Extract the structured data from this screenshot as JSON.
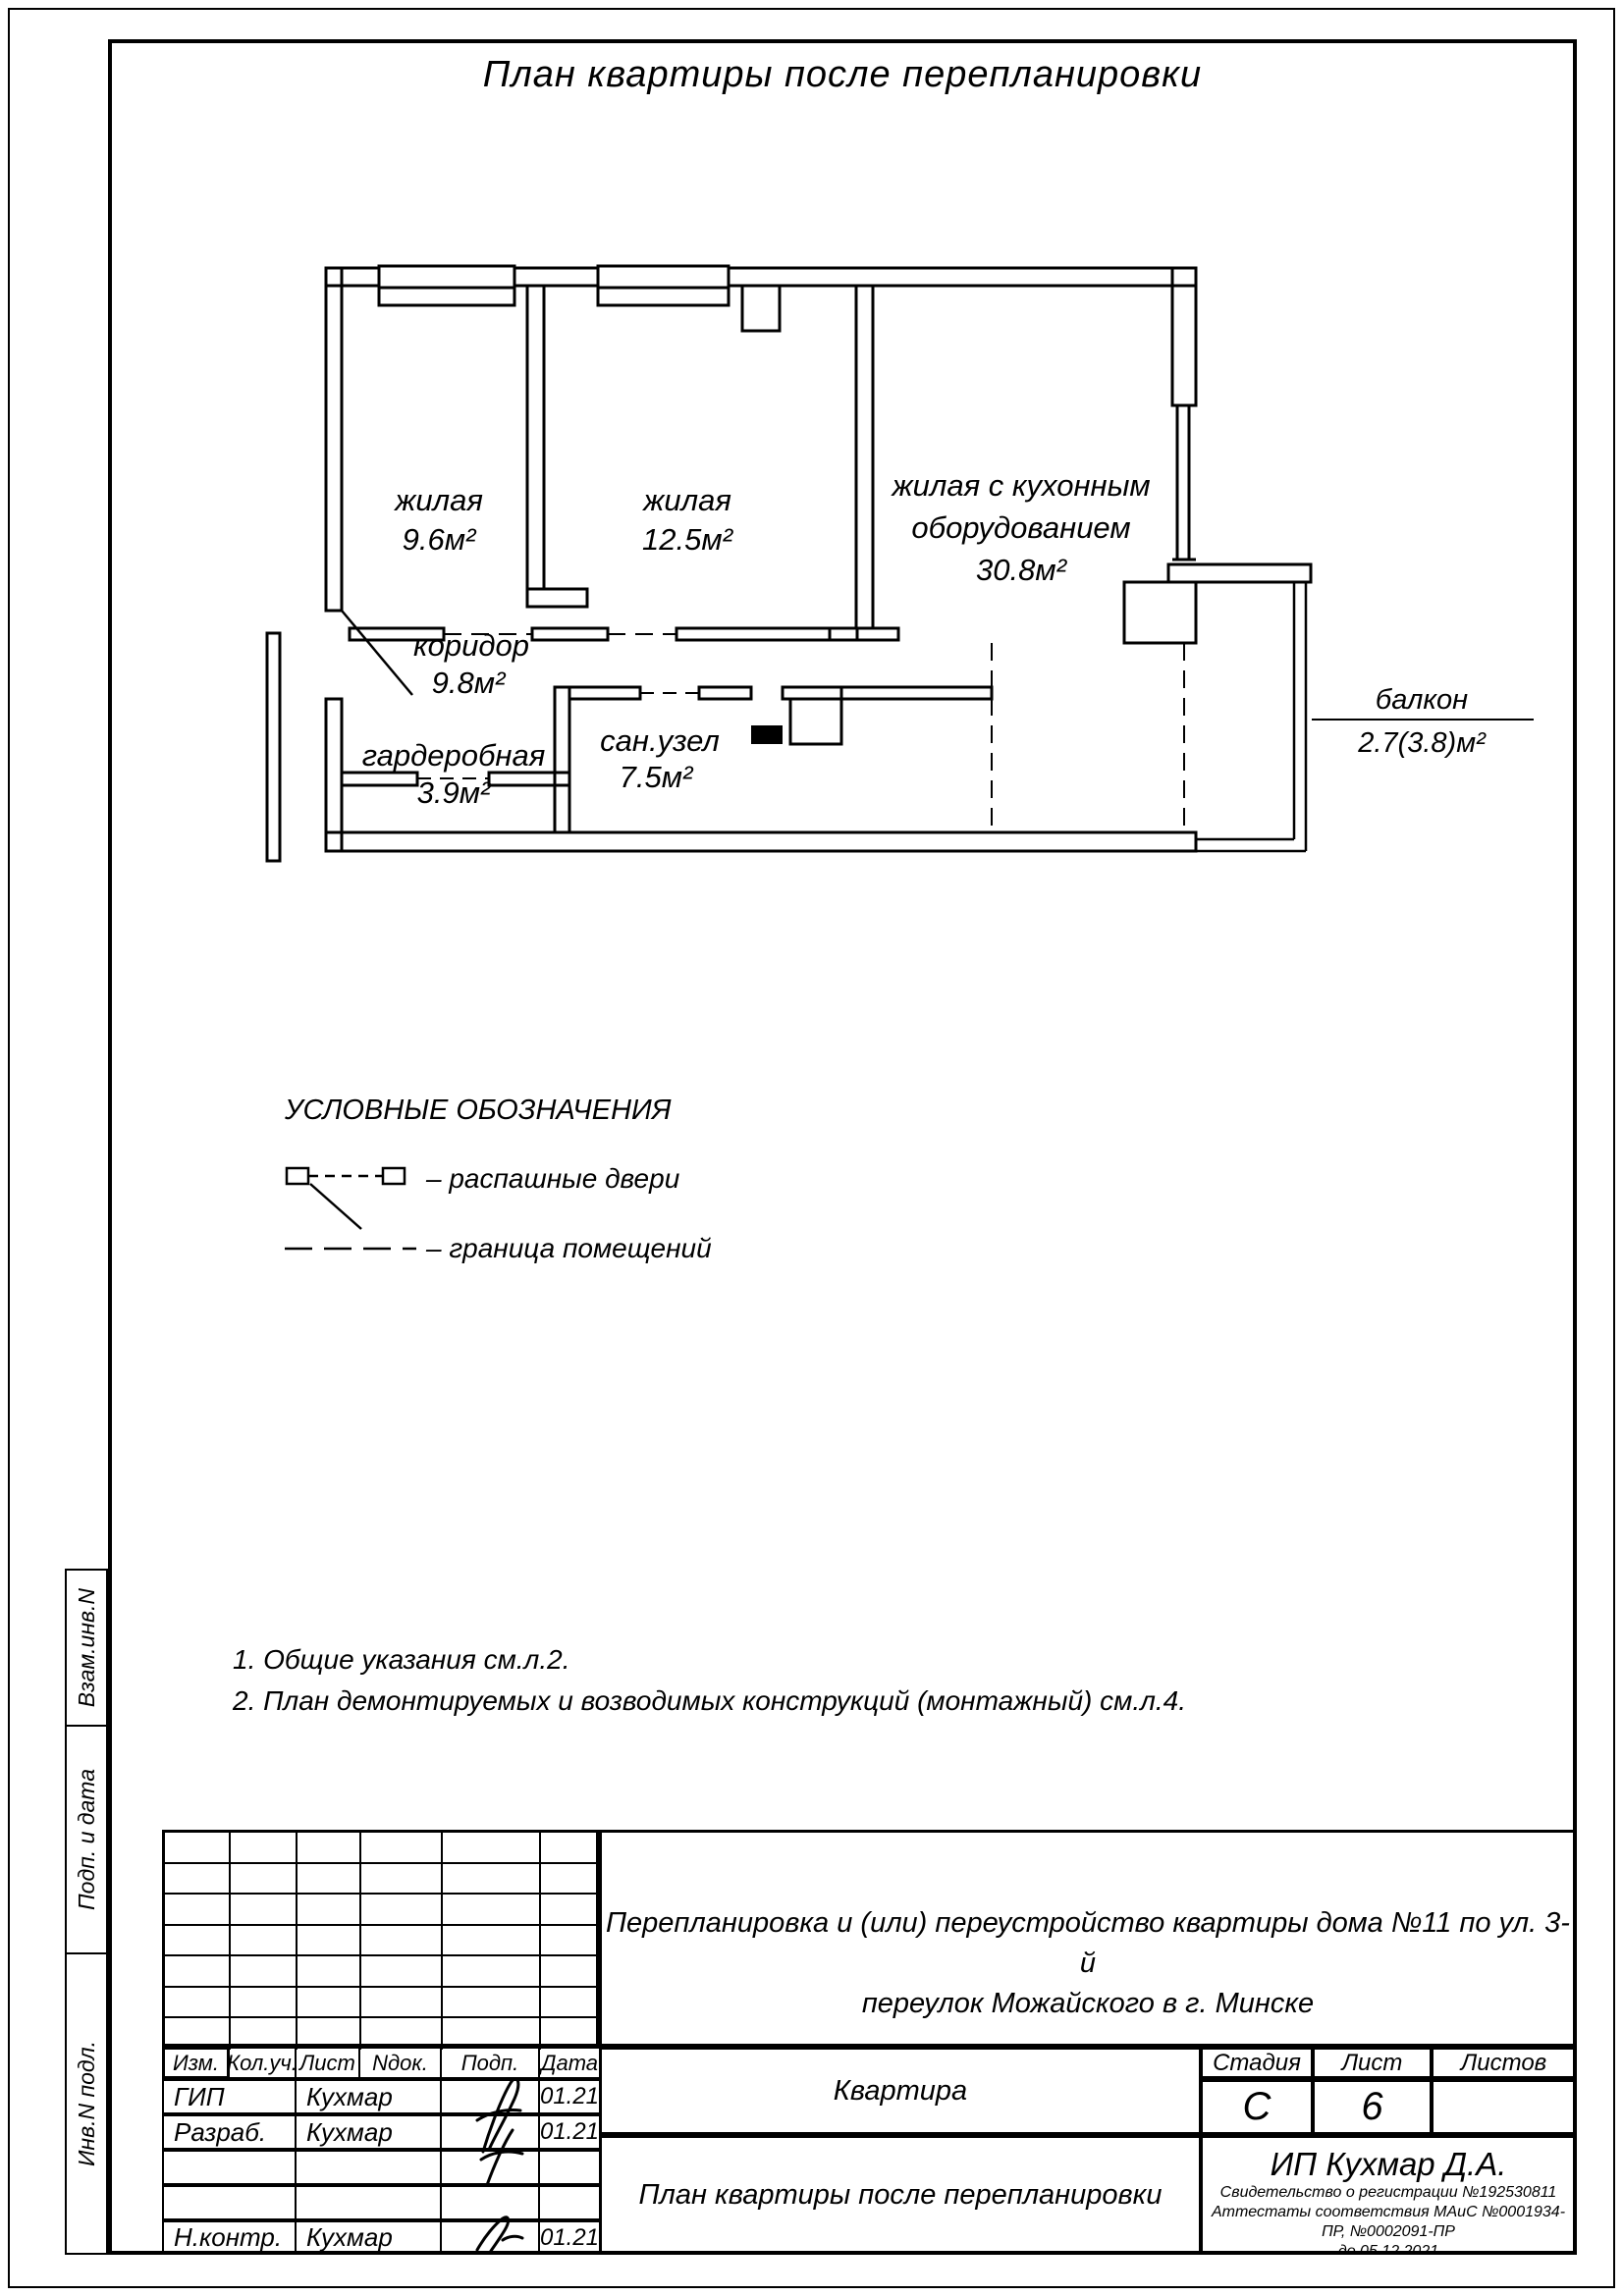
{
  "page": {
    "title": "План квартиры после перепланировки"
  },
  "plan": {
    "rooms": [
      {
        "name": "жилая",
        "area": "9.6м²"
      },
      {
        "name": "жилая",
        "area": "12.5м²"
      },
      {
        "name_line1": "жилая с кухонным",
        "name_line2": "оборудованием",
        "area": "30.8м²"
      },
      {
        "name": "коридор",
        "area": "9.8м²"
      },
      {
        "name": "гардеробная",
        "area": "3.9м²"
      },
      {
        "name": "сан.узел",
        "area": "7.5м²"
      },
      {
        "name": "балкон",
        "area": "2.7(3.8)м²"
      }
    ]
  },
  "legend": {
    "title": "УСЛОВНЫЕ ОБОЗНАЧЕНИЯ",
    "items": [
      {
        "label": "–  распашные двери"
      },
      {
        "label": "–  граница помещений"
      }
    ]
  },
  "notes": [
    "1. Общие указания см.л.2.",
    "2. План демонтируемых и возводимых конструкций (монтажный) см.л.4."
  ],
  "sidebar": {
    "labels": [
      "Взам.инв.N",
      "Подп. и дата",
      "Инв.N подл."
    ]
  },
  "titleblock": {
    "columns": [
      "Изм.",
      "Кол.уч.",
      "Лист",
      "Nдок.",
      "Подп.",
      "Дата"
    ],
    "rows": [
      {
        "role": "ГИП",
        "name": "Кухмар",
        "date": "01.21"
      },
      {
        "role": "Разраб.",
        "name": "Кухмар",
        "date": "01.21"
      },
      {
        "role": "",
        "name": "",
        "date": ""
      },
      {
        "role": "",
        "name": "",
        "date": ""
      },
      {
        "role": "Н.контр.",
        "name": "Кухмар",
        "date": "01.21"
      }
    ],
    "project_line1": "Перепланировка и (или) переустройство квартиры дома №11 по ул. 3-й",
    "project_line2": "переулок Можайского в г. Минске",
    "object": "Квартира",
    "stage_label": "Стадия",
    "sheet_label": "Лист",
    "sheets_label": "Листов",
    "stage": "С",
    "sheet": "6",
    "sheets": "",
    "drawing_title": "План квартиры после перепланировки",
    "company": "ИП Кухмар Д.А.",
    "cert_line1": "Свидетельство о регистрации №192530811",
    "cert_line2": "Аттестаты соответствия МАиС №0001934-ПР, №0002091-ПР",
    "cert_line3": "до 05.12.2021",
    "ink_color": "#000000",
    "paper_color": "#ffffff"
  }
}
